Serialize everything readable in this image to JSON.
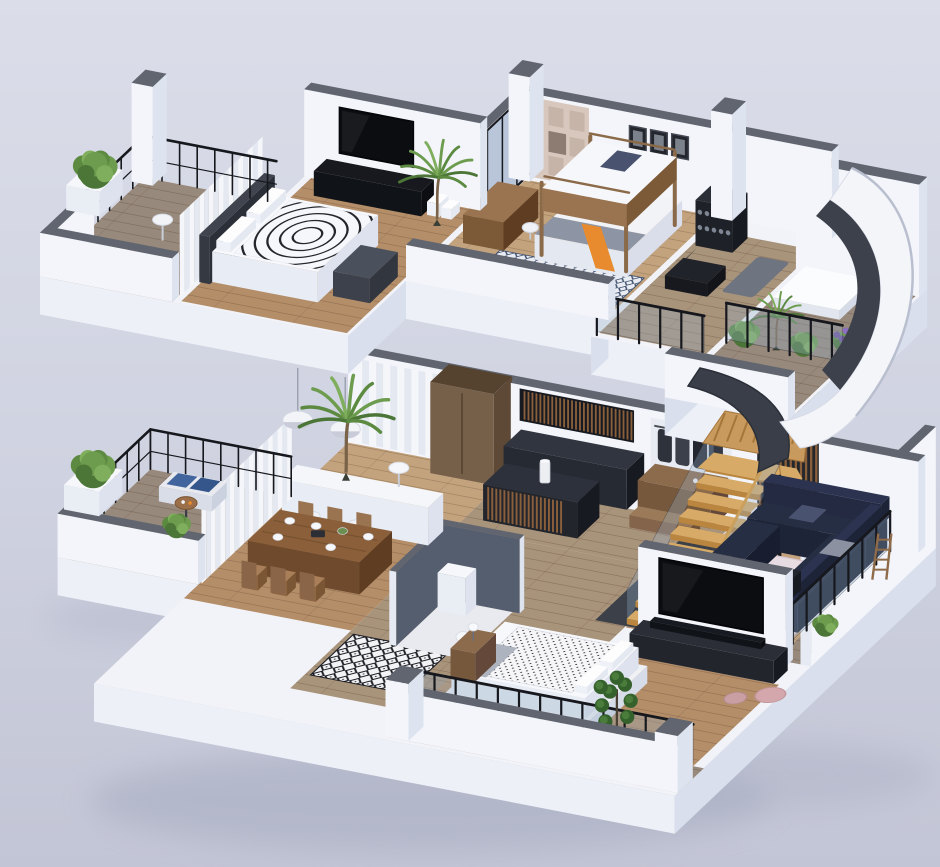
{
  "scene": {
    "title": "3D isometric cutaway render of a two-storey apartment floor plan",
    "view": "axonometric exploded two floors floating on lavender background",
    "floors": [
      {
        "name": "Upper floor",
        "rooms": [
          {
            "name": "Master bedroom",
            "furniture": [
              "double bed with arc-patterned duvet",
              "white pillows",
              "dark headboard",
              "grey ottoman",
              "black TV console",
              "wall TV",
              "white storage boxes",
              "palm plant",
              "white curtains"
            ]
          },
          {
            "name": "Kids bedroom",
            "furniture": [
              "wooden bunk bed",
              "orange slide",
              "desk",
              "white chair",
              "beige wall shelving unit",
              "three picture frames",
              "blue diamond rug",
              "black framed window wall"
            ]
          },
          {
            "name": "Home gym",
            "furniture": [
              "dumbbell rack",
              "workout bench",
              "exercise mat",
              "glass railing"
            ]
          },
          {
            "name": "Roof terrace",
            "furniture": [
              "skylight panel",
              "glass railing with black posts",
              "potted shrubs",
              "purple flower pot",
              "white parapet"
            ]
          },
          {
            "name": "Balcony",
            "furniture": [
              "black metal railing",
              "green shrub in white planter",
              "round side table",
              "white pillar"
            ]
          }
        ]
      },
      {
        "name": "Ground floor",
        "rooms": [
          {
            "name": "Dining room",
            "furniture": [
              "wooden dining table",
              "six wooden chairs",
              "place settings",
              "two white dome pendant lamps",
              "white counter",
              "white stools",
              "curtains"
            ]
          },
          {
            "name": "Kitchen",
            "furniture": [
              "dark cabinets",
              "wood slat island",
              "white cylinder lamp",
              "tall wooden wardrobe"
            ]
          },
          {
            "name": "Hallway",
            "furniture": [
              "coat closet",
              "wooden dresser",
              "shoe bench",
              "black and white diamond rug"
            ]
          },
          {
            "name": "Staircase",
            "furniture": [
              "floating wood treads",
              "glass balustrade",
              "wood slat screen",
              "curved dark ribbon wall",
              "black support post"
            ]
          },
          {
            "name": "Living room",
            "furniture": [
              "navy corner sofa",
              "grey cushions",
              "blush pink rug",
              "dark coffee table",
              "TV partition wall",
              "large TV",
              "dark media bench",
              "pink poufs"
            ]
          },
          {
            "name": "Bedroom",
            "furniture": [
              "double bed with dotted duvet",
              "grey throw",
              "wooden nightstand",
              "table lamp",
              "fiddle leaf plant",
              "green shrub",
              "glass railing"
            ]
          },
          {
            "name": "Balcony",
            "furniture": [
              "bistro table",
              "bench with blue plaid cushions",
              "black metal railing",
              "shrubs on parapet"
            ]
          },
          {
            "name": "Terrace walkway",
            "furniture": [
              "grey plank deck",
              "glass railing",
              "white parapet",
              "lounge chair",
              "potted plants",
              "ladder shelf"
            ]
          }
        ]
      }
    ],
    "features": [
      "large curved white arch wall with dark trim",
      "soft ground shadows",
      "grey wall caps on all cut walls"
    ]
  },
  "colors": {
    "bgTop": "#dbdde9",
    "bgMid": "#cfd2e0",
    "bgBot": "#c2c5d5",
    "shadow": "#a9aec2",
    "slabTop": "#f1f3f8",
    "slabS": "#edf0f7",
    "slabE": "#d9dfec",
    "capGrey": "#61656f",
    "wallFace": "#f3f5fa",
    "wallShade": "#e6eaf3",
    "wallSide": "#dde3ef",
    "white": "#fbfcfe",
    "offWhite": "#eef0f6",
    "wood1": "#b48e69",
    "wood2": "#a8937b",
    "wood3": "#c3a37e",
    "wood4": "#97897b",
    "woodFurn": "#9a7450",
    "woodFurnDark": "#7c5a38",
    "woodDeep": "#5e3d22",
    "wardrobe": "#77604a",
    "slat": "#8a5f3c",
    "dark1": "#22252c",
    "dark2": "#2c313c",
    "dark3": "#171a20",
    "navy": "#262e44",
    "navyDark": "#1d2438",
    "navySide": "#181e30",
    "pillowBlue": "#49536f",
    "pillowGrey": "#8b91a0",
    "stairWood": "#d7ab67",
    "stairRiser": "#b9853f",
    "glass": "rgba(150,175,200,0.32)",
    "post": "#16181d",
    "pinkRug": "#e7dce1",
    "pouf": "#d4a7ac",
    "green1": "#4c7637",
    "green2": "#5c8a41",
    "green3": "#6d9c4f",
    "green4": "#7fae5c",
    "fiddleGreen": "#35622c",
    "purple": "#8d6fc0",
    "purple2": "#6f549c",
    "orange": "#e78b2e",
    "slate": "#555e6e",
    "duvetGrey": "#aeb4bf",
    "headboard": "#3f444e",
    "ottoman": "#4a505c",
    "unitBeige": "#d8c7bd",
    "unitBeige2": "#c6b4a8",
    "niche": "#8d7c72",
    "tv": "#0b0d11",
    "frameDark": "#23262d",
    "curt1": "#f5f6fa",
    "curt2": "#e4e8f1",
    "ribbon": "#3a3e48",
    "arch": "#f3f5f9",
    "archTrim": "#3d414b",
    "blueCushion": "#41659c",
    "blueCushion2": "#35568a"
  }
}
